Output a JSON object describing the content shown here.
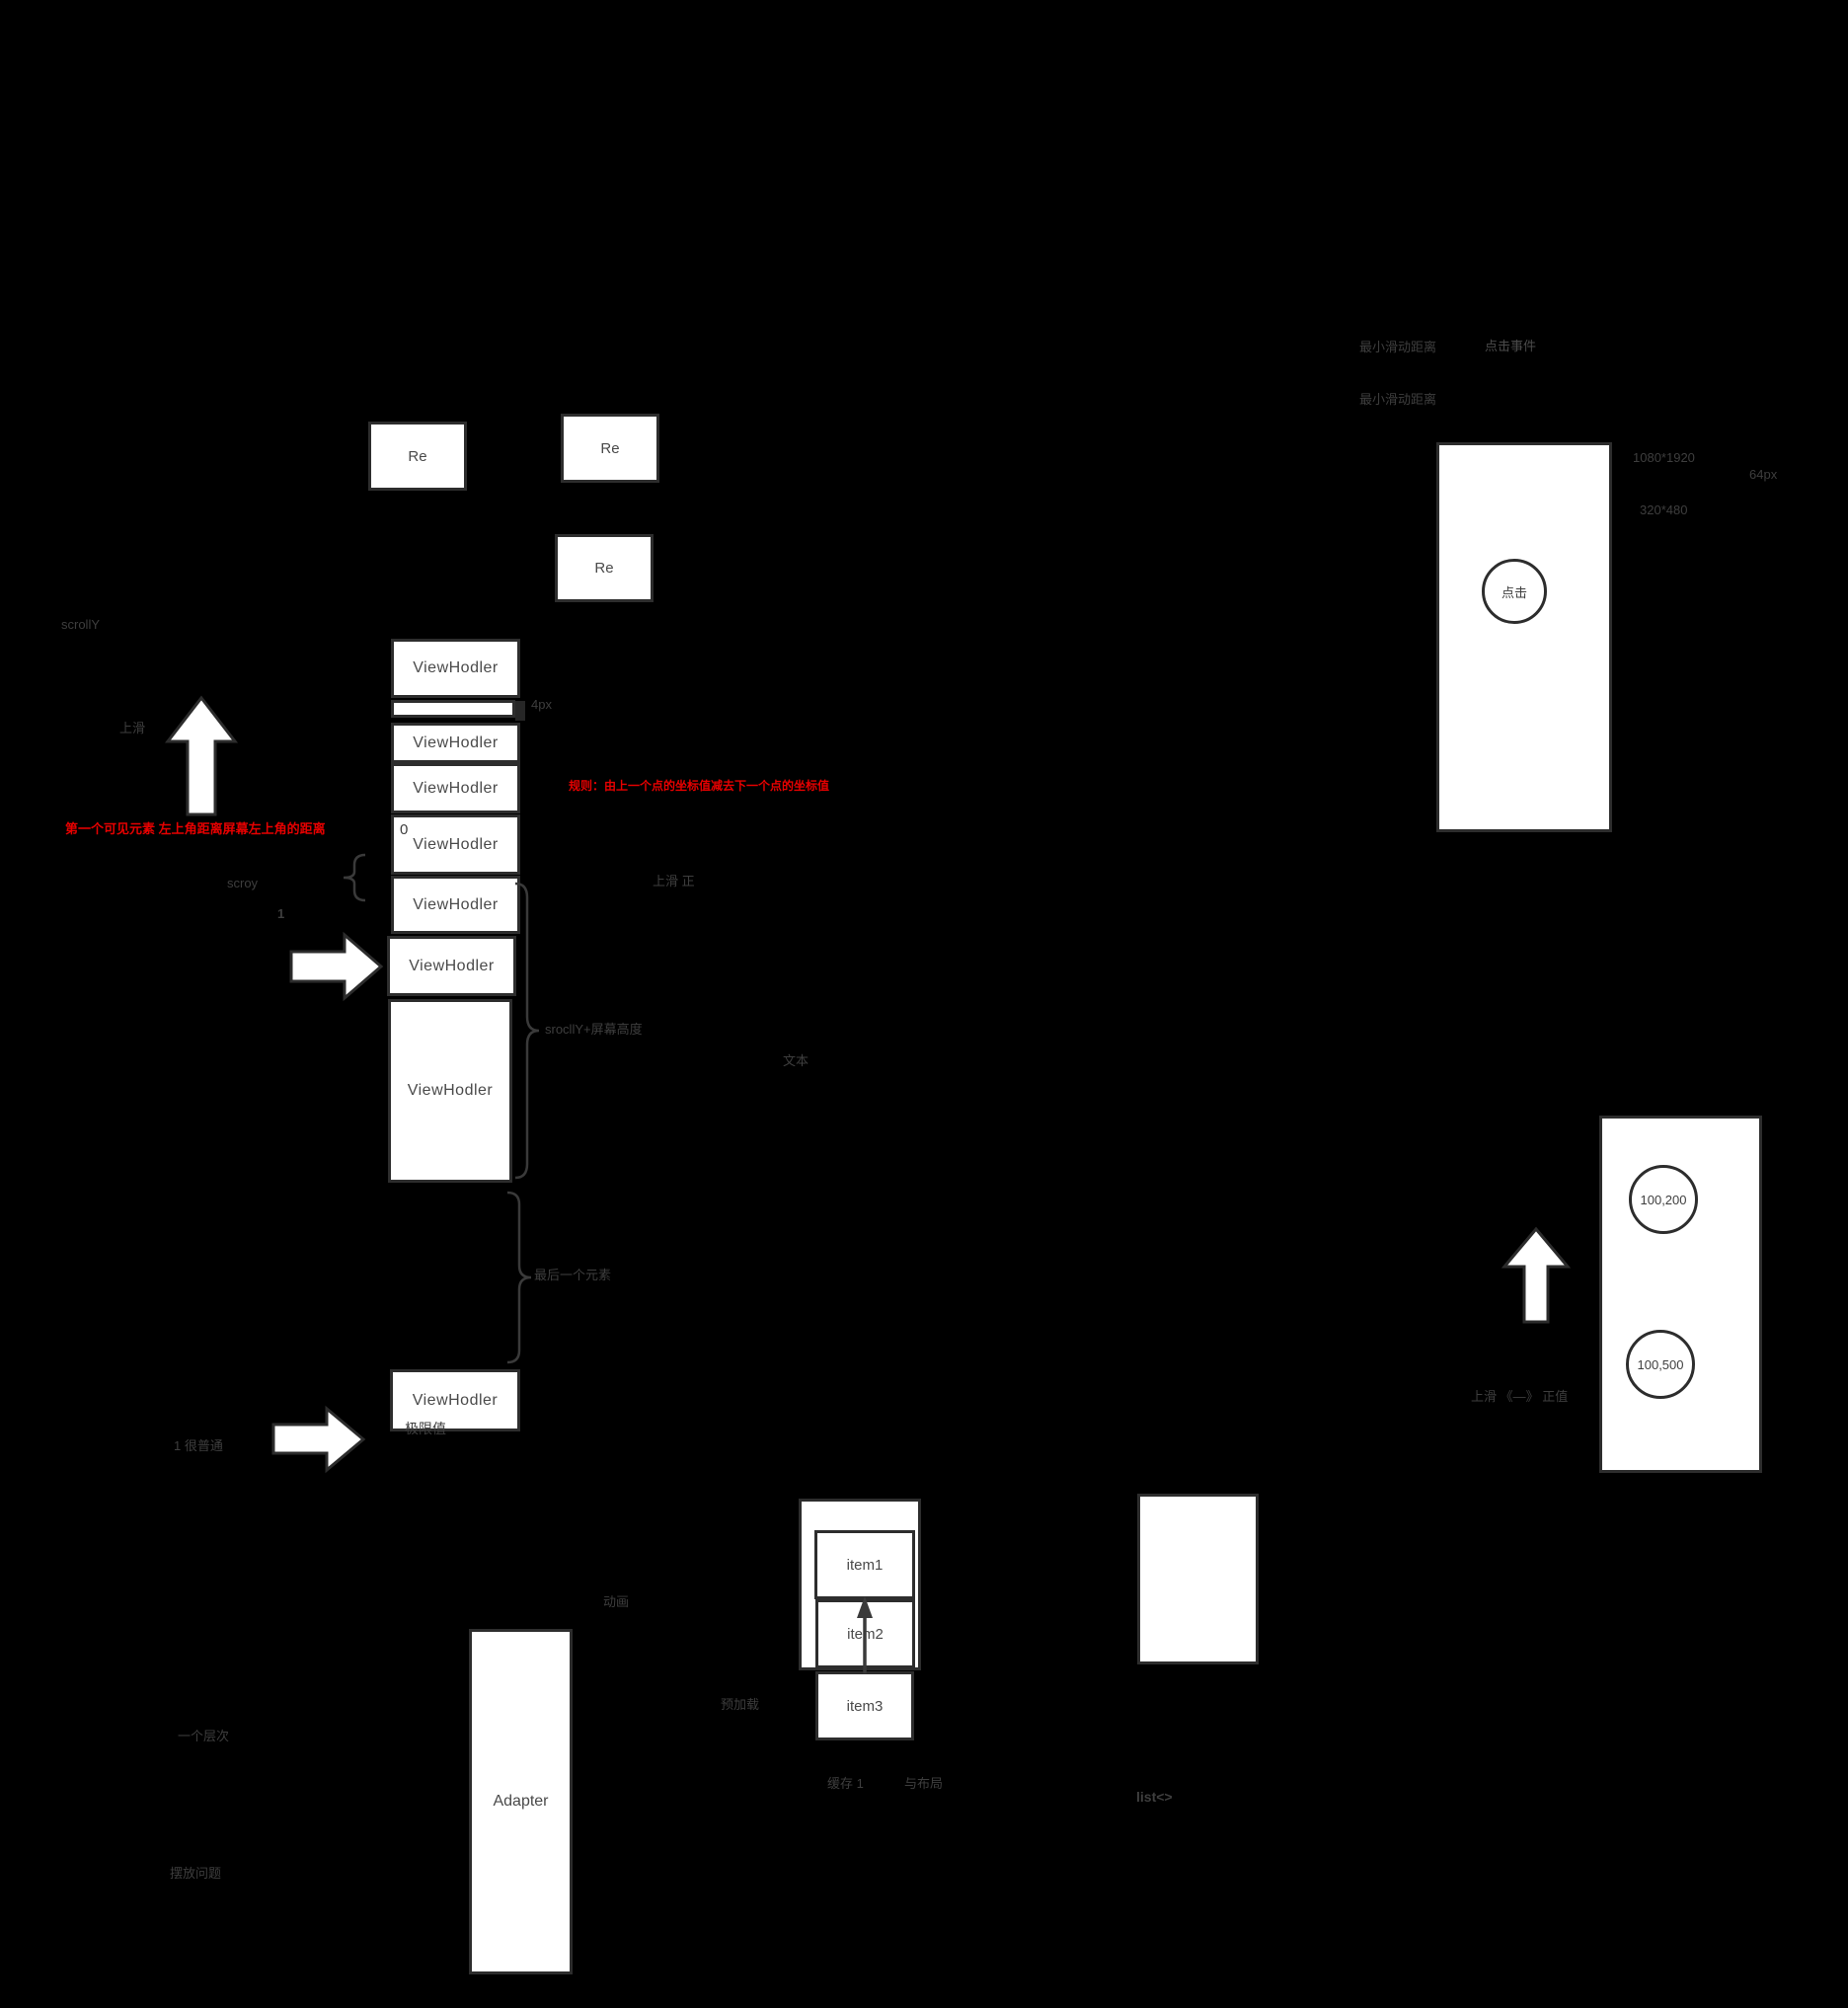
{
  "colors": {
    "background": "#000000",
    "box_fill": "#ffffff",
    "box_border": "#2d2d2d",
    "dim_text": "#3e3e3e",
    "box_text": "#4a4a4a",
    "accent_red": "#e60000"
  },
  "re_boxes": [
    {
      "label": "Re"
    },
    {
      "label": "Re"
    },
    {
      "label": "Re"
    }
  ],
  "stack": {
    "viewholders": [
      "ViewHodler",
      "ViewHodler",
      "ViewHodler",
      "ViewHodler",
      "ViewHodler",
      "ViewHodler",
      "ViewHodler"
    ],
    "detached_viewholder": "ViewHodler",
    "gap_label": "4px",
    "zero_label": "0"
  },
  "left": {
    "scrolly": "scrollY",
    "swipe_up": "上滑",
    "first_visible_note": "第一个可见元素 左上角距离屏幕左上角的距离",
    "scroy": "scroy",
    "index_one": "1",
    "limit_label": "极限值",
    "one_ordinary": "1  很普通",
    "one_level": "一个层次",
    "placement": "摆放问题"
  },
  "middle": {
    "rule_note": "规则：由上一个点的坐标值减去下一个点的坐标值",
    "swipe_positive": "上滑  正",
    "scroll_plus_screen": "srocllY+屏幕高度",
    "text_label": "文本",
    "last_element": "最后一个元素",
    "animation": "动画",
    "adapter": "Adapter",
    "preload": "预加载",
    "cache": "缓存  1",
    "with_layout": "与布局",
    "list": "list<>",
    "items": [
      "item1",
      "item2",
      "item3"
    ]
  },
  "right": {
    "min_slide_1": "最小滑动距离",
    "click_event": "点击事件",
    "min_slide_2": "最小滑动距离",
    "resolution_big": "1080*1920",
    "status_bar_px": "64px",
    "resolution_small": "320*480",
    "click_circle": "点击",
    "point_top": "100,200",
    "point_bottom": "100,500",
    "swipe_note": "上滑 《—》 正值"
  }
}
